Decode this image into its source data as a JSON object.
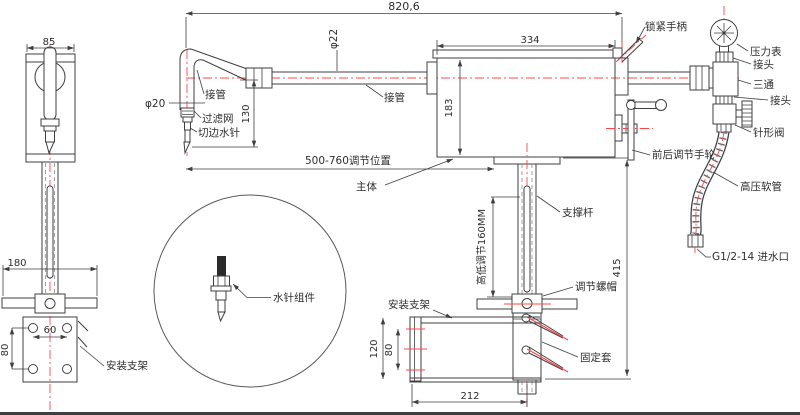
{
  "colors": {
    "line": "#3f3f42",
    "centerline": "#ff4747",
    "background": "#ffffff",
    "text": "#2e2e31"
  },
  "labels": {
    "dim_overall": "820,6",
    "dim_85": "85",
    "dia_22": "φ22",
    "dia_20": "φ20",
    "pipe_left": "接管",
    "pipe_mid": "接管",
    "filter_screen": "过滤网",
    "trim_water_needle": "切边水针",
    "dim_130": "130",
    "dim_334": "334",
    "dim_183": "183",
    "lock_handle": "锁紧手柄",
    "pressure_gauge": "压力表",
    "joint_top": "接头",
    "tee": "三通",
    "joint_bottom": "接头",
    "needle_valve": "针形阀",
    "hp_hose": "高压软管",
    "water_inlet": "G1/2-14 进水口",
    "fb_handwheel": "前后调节手轮",
    "adjust_range": "500-760调节位置",
    "main_body": "主体",
    "support_rod": "支撑杆",
    "height_adjust": "高低调节160MM",
    "dim_415": "415",
    "adjust_nut": "调节螺帽",
    "mount_bracket_front": "安装支架",
    "fixing_sleeve": "固定套",
    "dim_120": "120",
    "dim_80_front": "80",
    "dim_212": "212",
    "dim_180": "180",
    "dim_60": "60",
    "dim_80_left": "80",
    "mount_bracket_left": "安装支架",
    "needle_assembly": "水针组件"
  }
}
